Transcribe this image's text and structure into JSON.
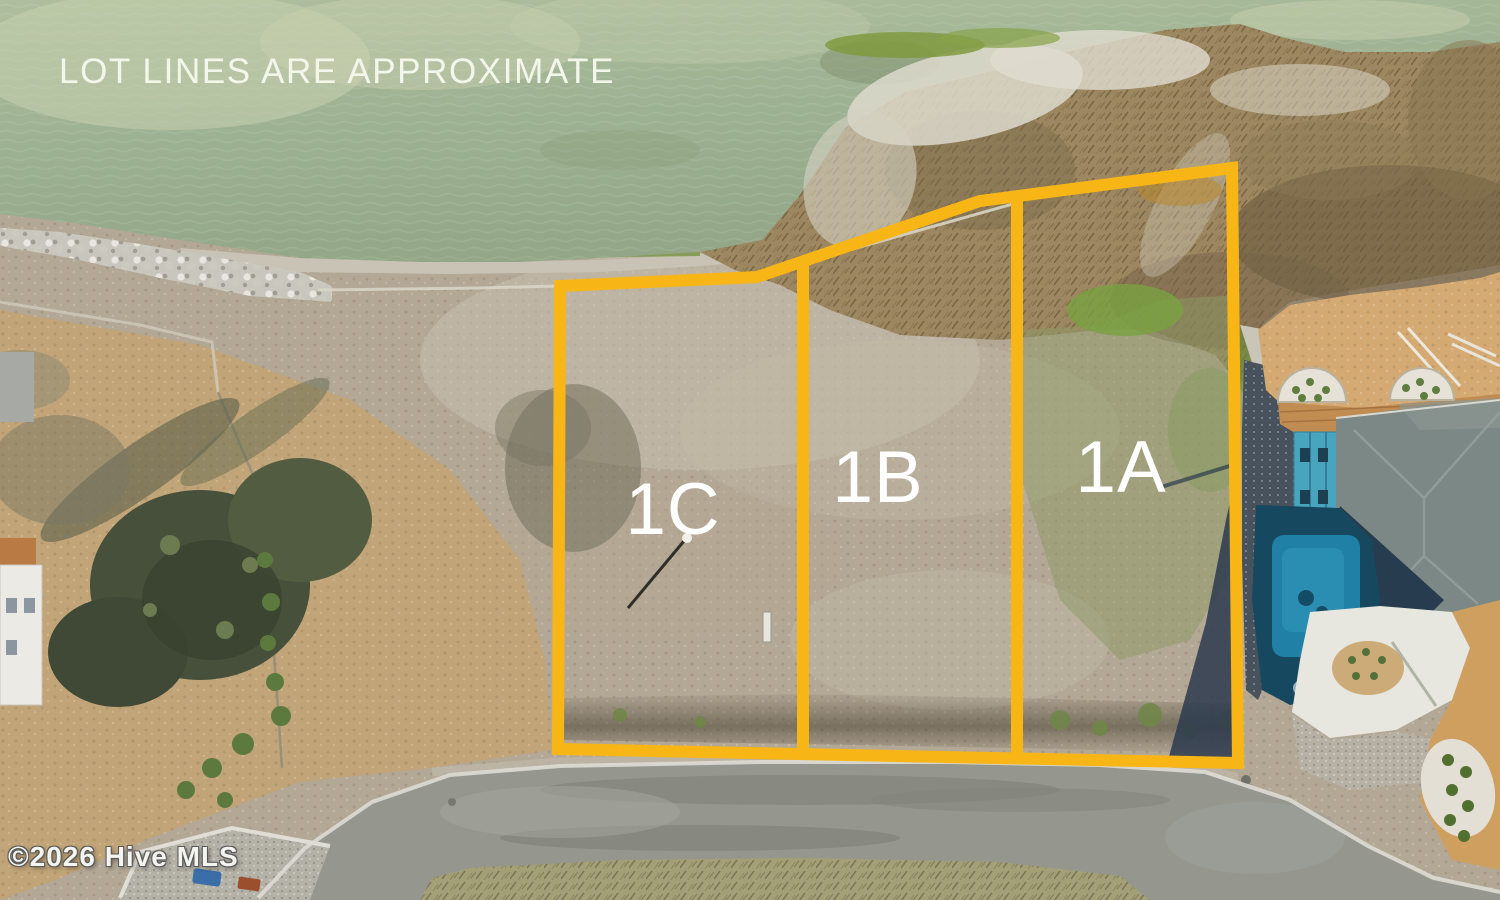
{
  "overlay": {
    "disclaimer": "LOT LINES ARE APPROXIMATE",
    "watermark": "©2026 Hive MLS",
    "lot_labels": [
      {
        "id": "lot-1c",
        "label": "1C"
      },
      {
        "id": "lot-1b",
        "label": "1B"
      },
      {
        "id": "lot-1a",
        "label": "1A"
      }
    ],
    "lot_line_color": "#F8B616",
    "label_color": "#FFFFFF"
  }
}
